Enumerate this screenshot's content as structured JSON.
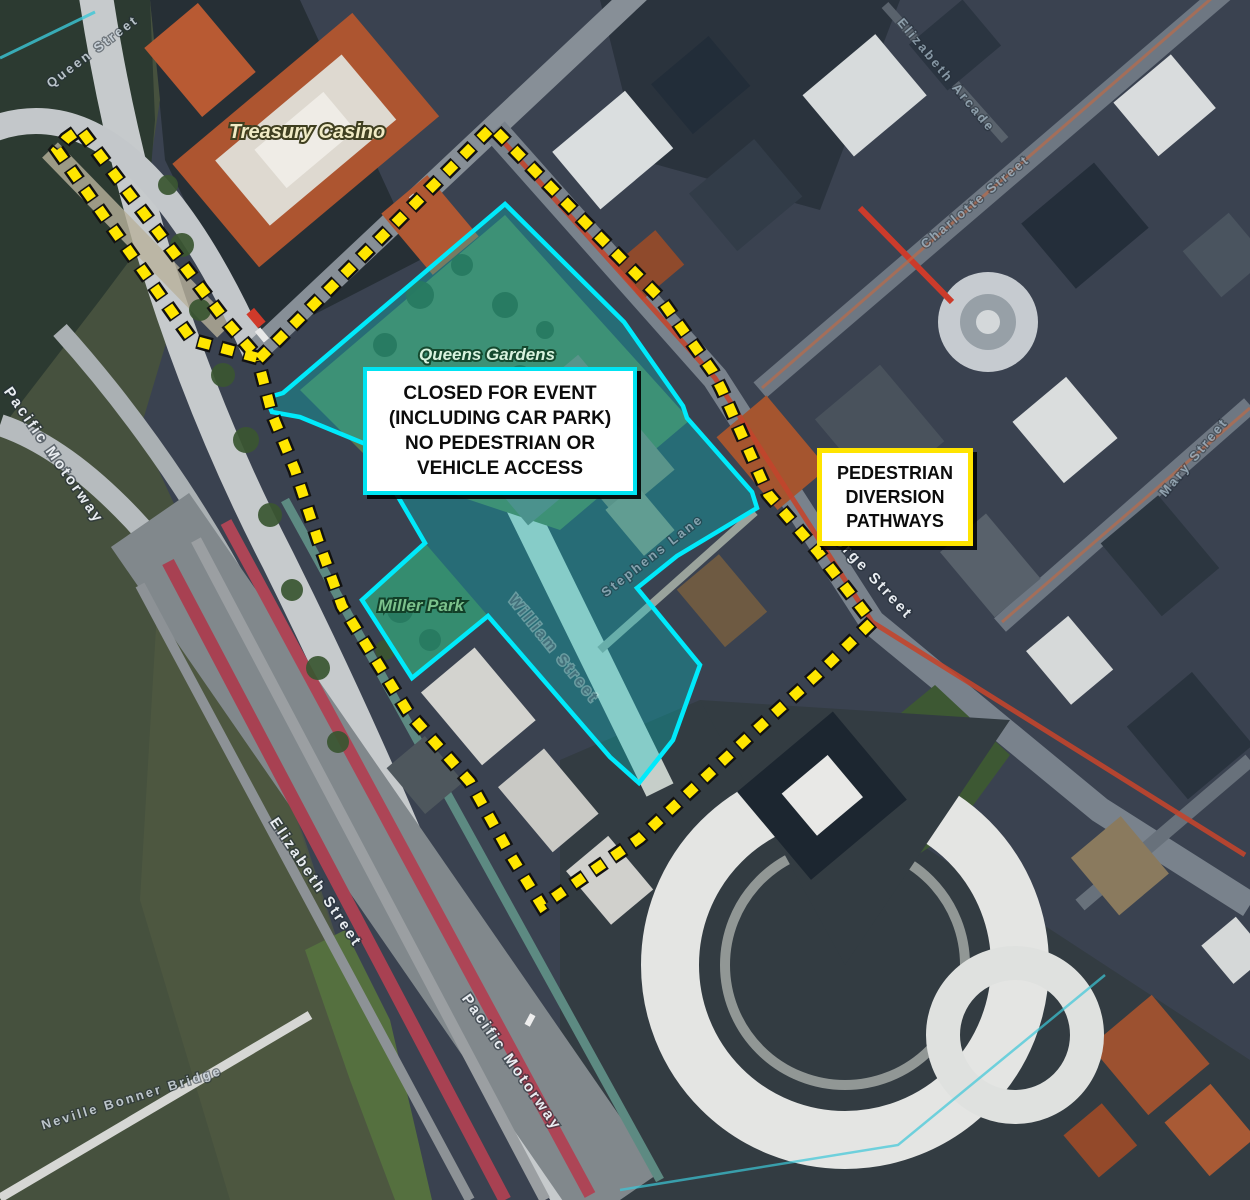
{
  "map": {
    "annotations": {
      "closed_box": {
        "lines": [
          "CLOSED FOR EVENT",
          "(INCLUDING CAR PARK)",
          "NO PEDESTRIAN OR",
          "VEHICLE ACCESS"
        ],
        "border_color": "#00E4F2"
      },
      "diversion_box": {
        "lines": [
          "PEDESTRIAN",
          "DIVERSION",
          "PATHWAYS"
        ],
        "border_color": "#FFE400"
      }
    },
    "overlays": {
      "closed_area_color": "#00EAFB",
      "diversion_path_color": "#FFE600"
    },
    "poi_labels": [
      {
        "text": "Treasury Casino"
      },
      {
        "text": "Queens Gardens"
      },
      {
        "text": "Miller Park"
      }
    ],
    "street_labels": [
      {
        "text": "Queen Street"
      },
      {
        "text": "Elizabeth Arcade"
      },
      {
        "text": "Charlotte Street"
      },
      {
        "text": "George Street"
      },
      {
        "text": "Mary Street"
      },
      {
        "text": "Elizabeth Street"
      },
      {
        "text": "Pacific Motorway"
      },
      {
        "text": "Pacific Motorway"
      },
      {
        "text": "William Street"
      },
      {
        "text": "Stephens Lane"
      },
      {
        "text": "Neville Bonner Bridge"
      }
    ]
  }
}
